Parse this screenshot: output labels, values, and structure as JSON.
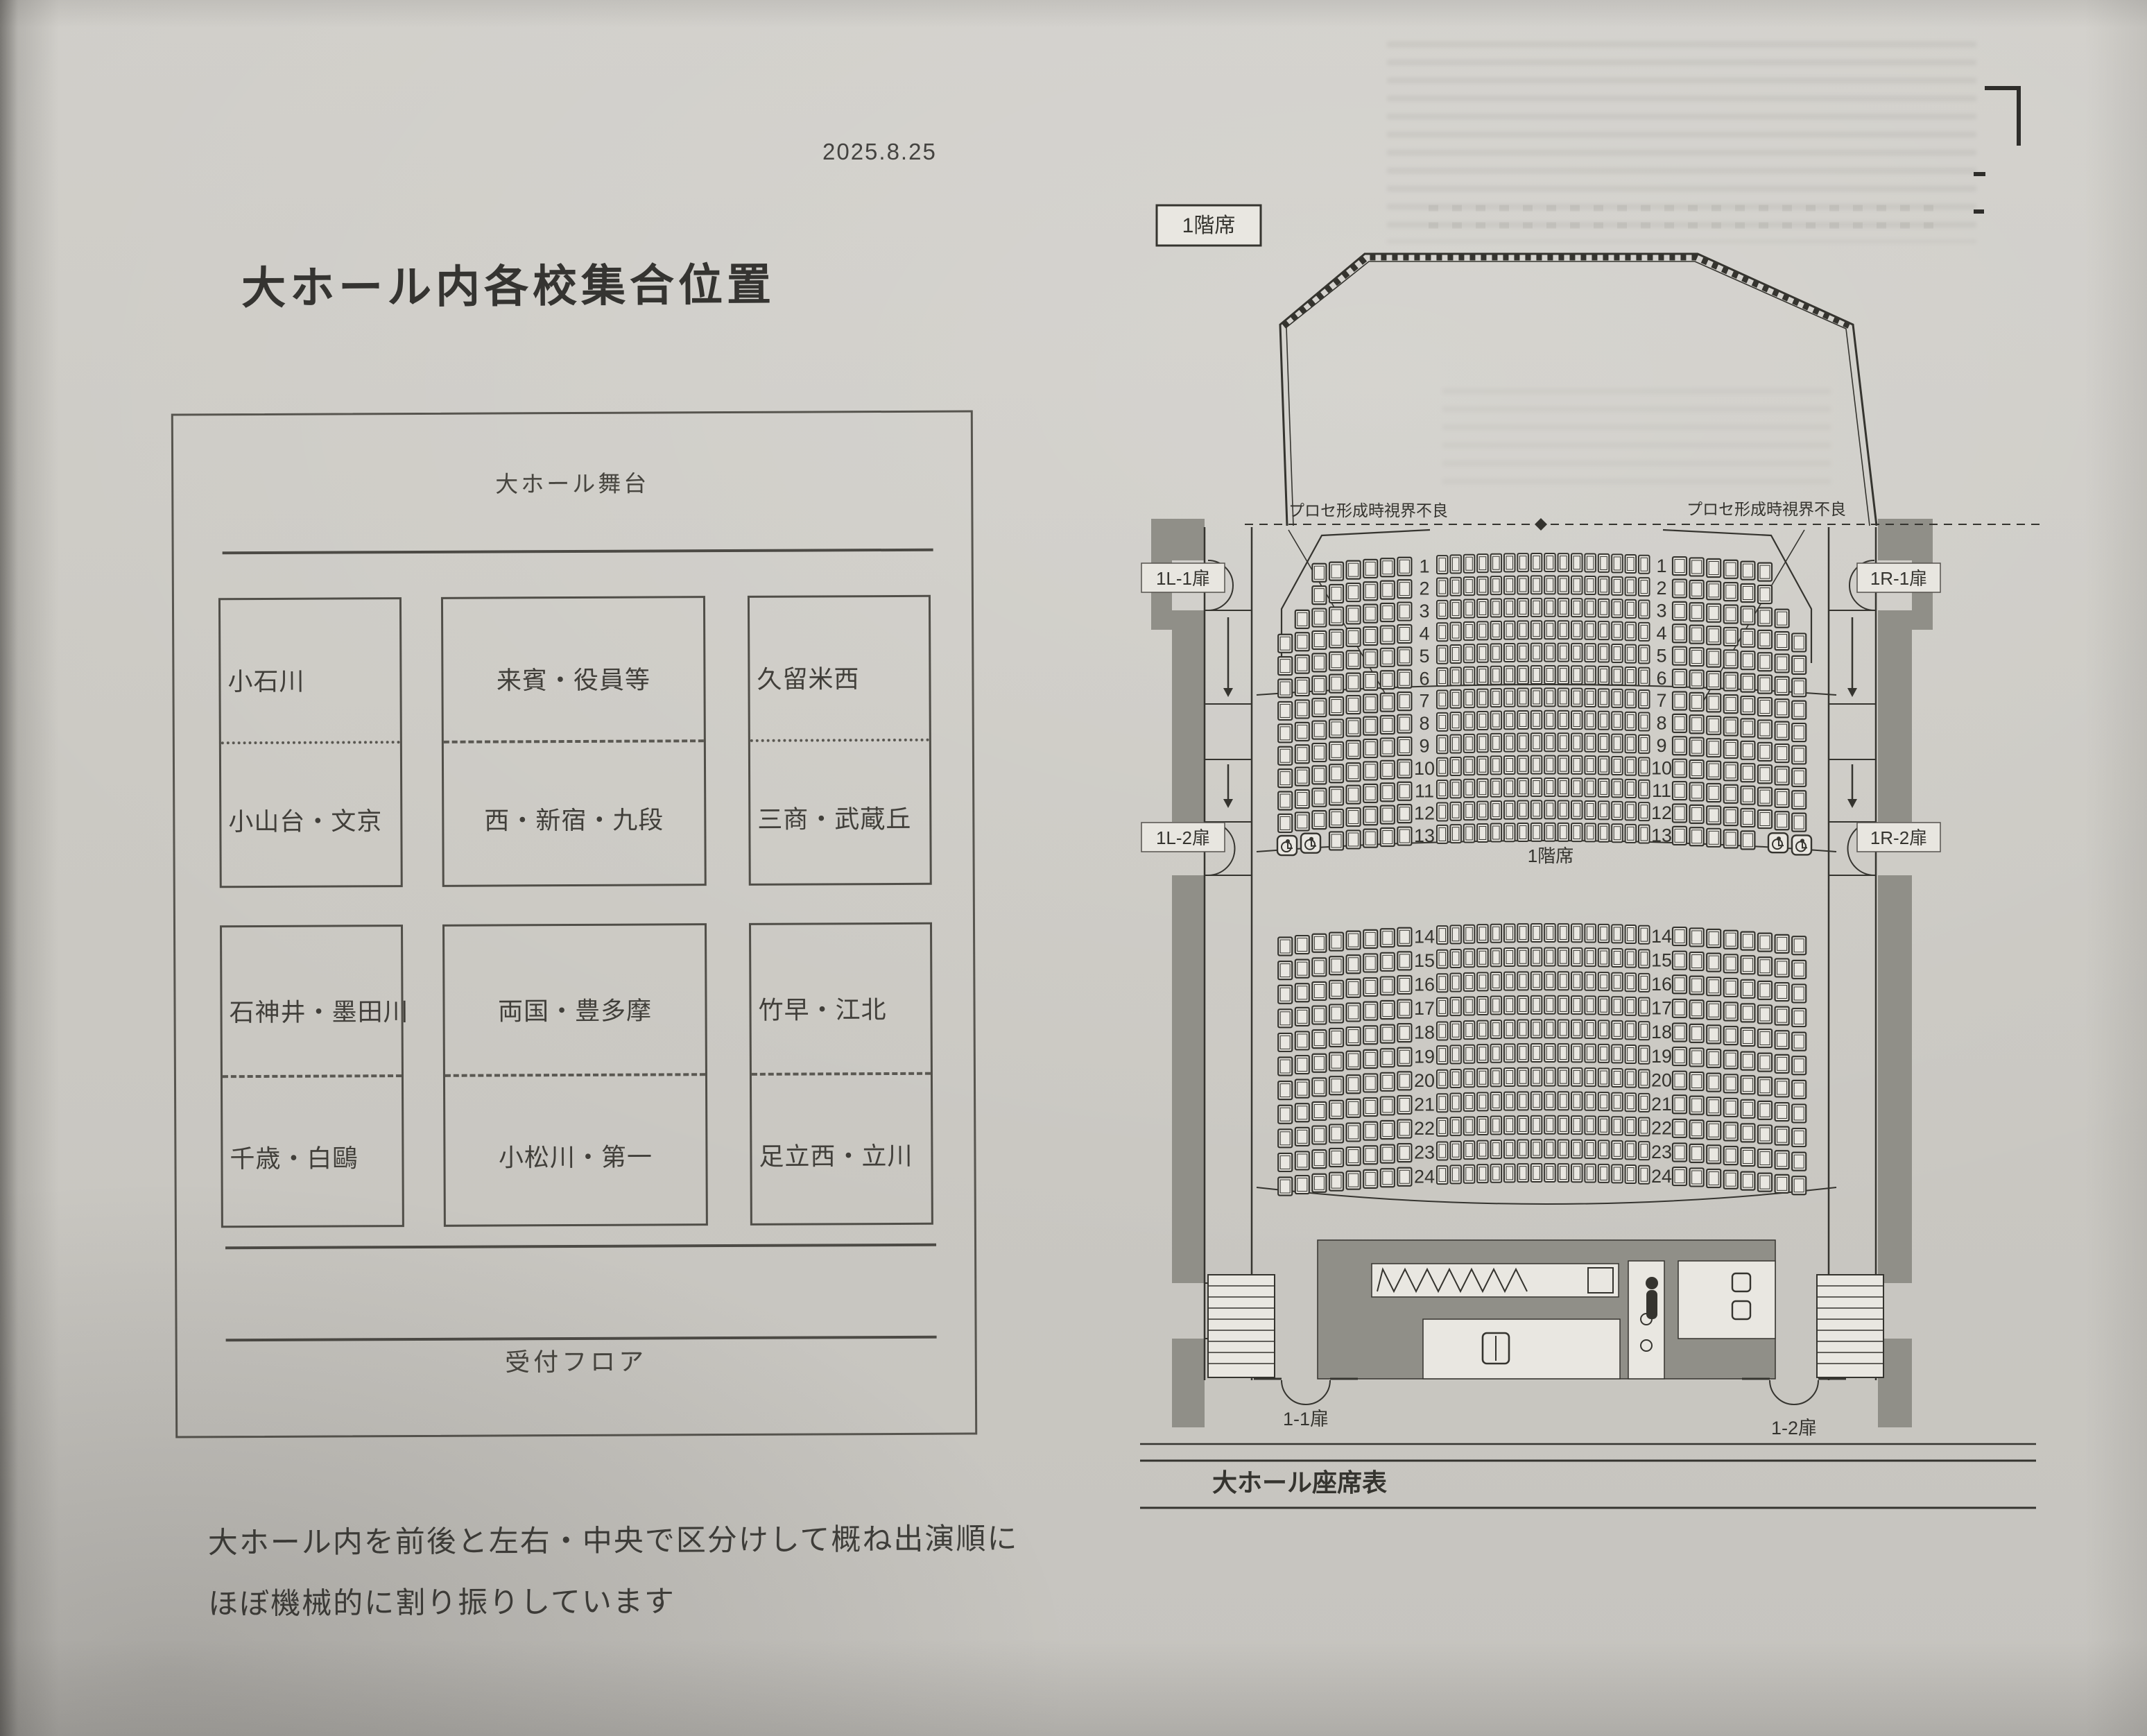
{
  "page": {
    "date": "2025.8.25",
    "title": "大ホール内各校集合位置",
    "footnote_line1": "大ホール内を前後と左右・中央で区分けして概ね出演順に",
    "footnote_line2": "ほぼ機械的に割り振りしています"
  },
  "floor_plan": {
    "stage_label": "大ホール舞台",
    "reception_label": "受付フロア",
    "cells": [
      {
        "top": "小石川",
        "bottom": "小山台・文京"
      },
      {
        "top": "来賓・役員等",
        "bottom": "西・新宿・九段"
      },
      {
        "top": "久留米西",
        "bottom": "三商・武蔵丘"
      },
      {
        "top": "石神井・墨田川",
        "bottom": "千歳・白鷗"
      },
      {
        "top": "両国・豊多摩",
        "bottom": "小松川・第一"
      },
      {
        "top": "竹早・江北",
        "bottom": "足立西・立川"
      }
    ]
  },
  "seat_chart": {
    "floor_label": "1階席",
    "mid_label": "1階席",
    "chart_title": "大ホール座席表",
    "visibility_note_left": "プロセ形成時視界不良",
    "visibility_note_right": "プロセ形成時視界不良",
    "doors": {
      "left_upper": "1L-1扉",
      "left_lower": "1L-2扉",
      "right_upper": "1R-1扉",
      "right_lower": "1R-2扉",
      "bottom_left": "1-1扉",
      "bottom_right": "1-2扉"
    },
    "front_rows": {
      "start": 1,
      "end": 13
    },
    "back_rows": {
      "start": 14,
      "end": 24
    },
    "seats_per_row": {
      "side": 8,
      "center": 16
    },
    "special_side_counts": {
      "1": 6,
      "2": 6,
      "3": 7,
      "13": 5
    },
    "wheelchair_row": 13,
    "wheelchair_per_side": 2
  }
}
